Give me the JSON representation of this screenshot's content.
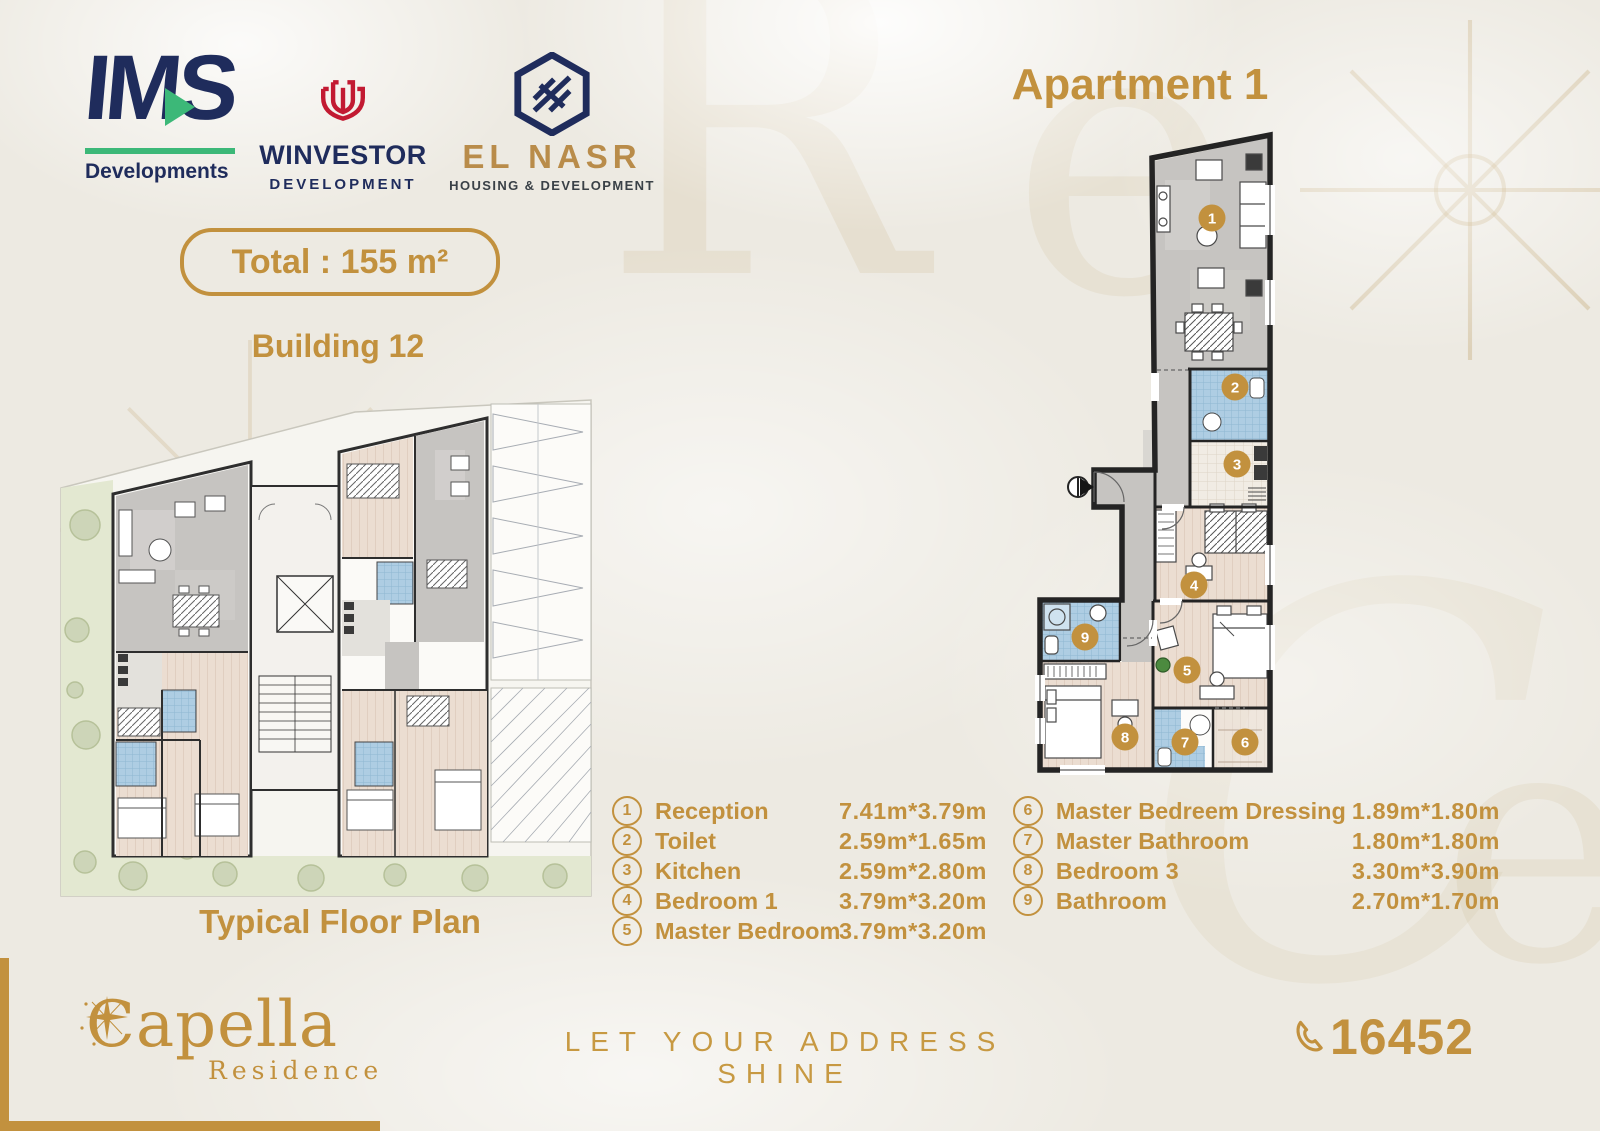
{
  "brand_colors": {
    "gold": "#C2913E",
    "navy": "#1F2C5C",
    "green": "#3CB878",
    "elnasr_gold": "#B98C4A",
    "winvestor_red": "#C21A32"
  },
  "header": {
    "logos": {
      "ims": {
        "title": "IMS",
        "subtitle": "Developments"
      },
      "winvestor": {
        "title": "WINVESTOR",
        "subtitle": "DEVELOPMENT"
      },
      "elnasr": {
        "title": "EL NASR",
        "subtitle": "HOUSING & DEVELOPMENT"
      }
    },
    "total_badge": "Total : 155 m²",
    "building_label": "Building 12",
    "apartment_title": "Apartment 1"
  },
  "plans": {
    "typical_caption": "Typical Floor Plan",
    "apartment_markers": [
      {
        "n": "1",
        "x": 212,
        "y": 88
      },
      {
        "n": "2",
        "x": 235,
        "y": 257
      },
      {
        "n": "3",
        "x": 237,
        "y": 334
      },
      {
        "n": "4",
        "x": 194,
        "y": 455
      },
      {
        "n": "5",
        "x": 187,
        "y": 540
      },
      {
        "n": "6",
        "x": 245,
        "y": 612
      },
      {
        "n": "7",
        "x": 185,
        "y": 612
      },
      {
        "n": "8",
        "x": 125,
        "y": 607
      },
      {
        "n": "9",
        "x": 85,
        "y": 507
      }
    ]
  },
  "legend": {
    "columns": [
      [
        {
          "num": "1",
          "label": "Reception",
          "dim": "7.41m*3.79m"
        },
        {
          "num": "2",
          "label": "Toilet",
          "dim": "2.59m*1.65m"
        },
        {
          "num": "3",
          "label": "Kitchen",
          "dim": "2.59m*2.80m"
        },
        {
          "num": "4",
          "label": "Bedroom 1",
          "dim": "3.79m*3.20m"
        },
        {
          "num": "5",
          "label": "Master Bedroom",
          "dim": "3.79m*3.20m"
        }
      ],
      [
        {
          "num": "6",
          "label": "Master Bedreem Dressing",
          "dim": "1.89m*1.80m"
        },
        {
          "num": "7",
          "label": "Master Bathroom",
          "dim": "1.80m*1.80m"
        },
        {
          "num": "8",
          "label": "Bedroom 3",
          "dim": "3.30m*3.90m"
        },
        {
          "num": "9",
          "label": "Bathroom",
          "dim": "2.70m*1.70m"
        }
      ]
    ]
  },
  "footer": {
    "brand": "Capella",
    "brand_sub": "Residence",
    "tagline": "LET YOUR ADDRESS SHINE",
    "phone": "16452"
  }
}
